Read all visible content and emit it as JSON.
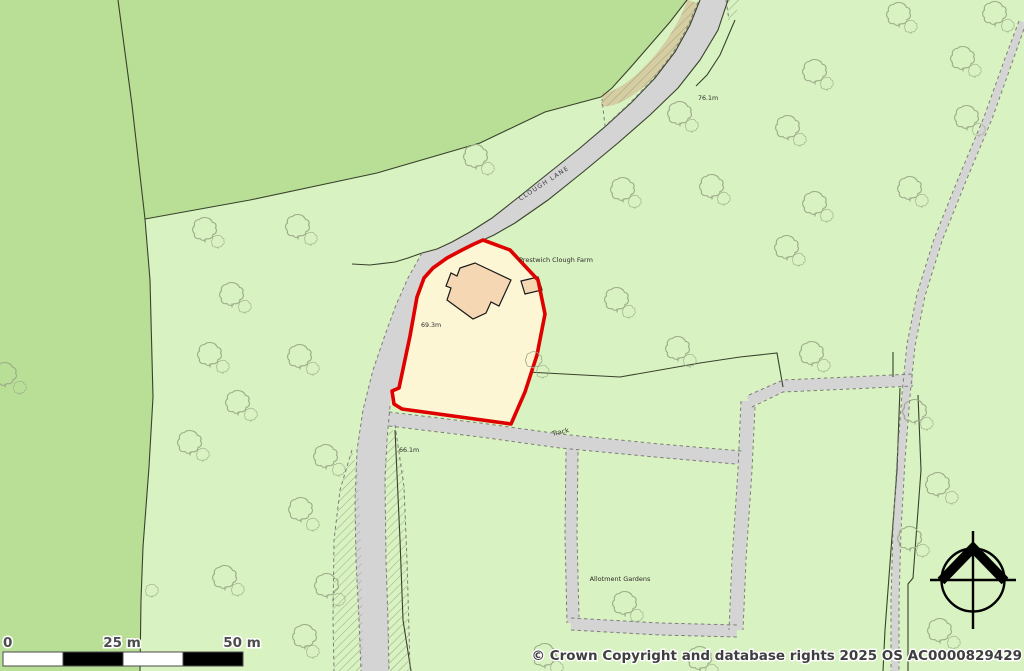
{
  "map": {
    "labels": {
      "road_name": "CLOUGH LANE",
      "farm": "Prestwich Clough Farm",
      "track": "Track",
      "allotments": "Allotment Gardens",
      "spot_height_top": "76.1m",
      "spot_height_plot": "69.3m",
      "spot_height_road": "66.1m"
    },
    "scale_bar": {
      "tick_0": "0",
      "tick_25": "25 m",
      "tick_50": "50 m"
    },
    "copyright": "© Crown Copyright and database rights 2025 OS AC0000829429",
    "colors": {
      "field_light_green": "#d9f2c1",
      "field_medium_green": "#b9df97",
      "road_gray": "#d4d4d4",
      "verge_tan": "#d6cda2",
      "plot_fill_cream": "#fcf6d4",
      "plot_boundary_red": "#df0000",
      "building_fill": "#f5d7b4",
      "boundary_line": "#38422c",
      "compass_black": "#000000"
    },
    "trees": [
      [
        205,
        228,
        1
      ],
      [
        218,
        241,
        0.55
      ],
      [
        232,
        293,
        1
      ],
      [
        245,
        306,
        0.55
      ],
      [
        210,
        353,
        1
      ],
      [
        223,
        366,
        0.55
      ],
      [
        238,
        401,
        1
      ],
      [
        251,
        414,
        0.55
      ],
      [
        190,
        441,
        1
      ],
      [
        203,
        454,
        0.55
      ],
      [
        298,
        225,
        1
      ],
      [
        311,
        238,
        0.55
      ],
      [
        300,
        355,
        1
      ],
      [
        313,
        368,
        0.55
      ],
      [
        326,
        455,
        1
      ],
      [
        339,
        469,
        0.55
      ],
      [
        301,
        508,
        1
      ],
      [
        313,
        524,
        0.55
      ],
      [
        225,
        576,
        1
      ],
      [
        238,
        589,
        0.55
      ],
      [
        327,
        584,
        1
      ],
      [
        339,
        599,
        0.55
      ],
      [
        305,
        635,
        1
      ],
      [
        313,
        651,
        0.55
      ],
      [
        152,
        590,
        0.55
      ],
      [
        5,
        373,
        1
      ],
      [
        20,
        387,
        0.55
      ],
      [
        476,
        155,
        1
      ],
      [
        488,
        168,
        0.55
      ],
      [
        623,
        188,
        1
      ],
      [
        635,
        201,
        0.55
      ],
      [
        680,
        112,
        1
      ],
      [
        692,
        125,
        0.55
      ],
      [
        712,
        185,
        1
      ],
      [
        724,
        198,
        0.55
      ],
      [
        815,
        70,
        1
      ],
      [
        827,
        83,
        0.55
      ],
      [
        963,
        57,
        1
      ],
      [
        975,
        70,
        0.55
      ],
      [
        899,
        13,
        1
      ],
      [
        911,
        26,
        0.55
      ],
      [
        995,
        12,
        1
      ],
      [
        1008,
        25,
        0.55
      ],
      [
        788,
        126,
        1
      ],
      [
        800,
        139,
        0.55
      ],
      [
        967,
        116,
        1
      ],
      [
        979,
        129,
        0.55
      ],
      [
        815,
        202,
        1
      ],
      [
        827,
        215,
        0.55
      ],
      [
        910,
        187,
        1
      ],
      [
        922,
        200,
        0.55
      ],
      [
        787,
        246,
        1
      ],
      [
        799,
        259,
        0.55
      ],
      [
        617,
        298,
        1
      ],
      [
        629,
        311,
        0.55
      ],
      [
        678,
        347,
        1
      ],
      [
        690,
        360,
        0.55
      ],
      [
        534,
        359,
        0.7
      ],
      [
        543,
        371,
        0.55
      ],
      [
        812,
        352,
        1
      ],
      [
        824,
        365,
        0.55
      ],
      [
        915,
        410,
        1
      ],
      [
        927,
        423,
        0.55
      ],
      [
        938,
        483,
        1
      ],
      [
        952,
        497,
        0.55
      ],
      [
        910,
        537,
        1
      ],
      [
        923,
        550,
        0.55
      ],
      [
        940,
        629,
        1
      ],
      [
        954,
        642,
        0.55
      ],
      [
        625,
        602,
        1
      ],
      [
        637,
        615,
        0.55
      ],
      [
        545,
        654,
        1
      ],
      [
        557,
        667,
        0.55
      ],
      [
        700,
        657,
        1
      ],
      [
        712,
        670,
        0.55
      ]
    ]
  }
}
